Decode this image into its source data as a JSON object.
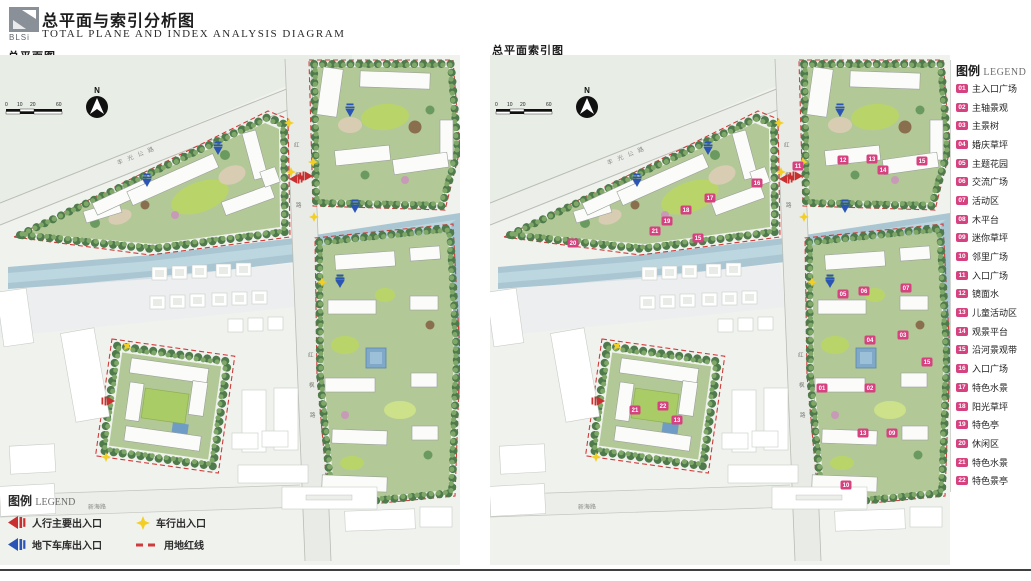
{
  "header": {
    "logo_text": "BLSi",
    "title": "总平面与索引分析图",
    "subtitle": "TOTAL PLANE AND INDEX ANALYSIS DIAGRAM"
  },
  "plans": {
    "left": {
      "title": "总平面图",
      "subtitle": "GENERAL PLAN ANALYSIS"
    },
    "right": {
      "title": "总平面索引图",
      "subtitle": "TOTAL PLANE INDEX GRAPH"
    }
  },
  "map": {
    "north_label": "N",
    "scale_ticks": [
      "0",
      "10",
      "20",
      "60"
    ],
    "road_labels": {
      "highway": "丰光公路",
      "bottom": "新海路"
    },
    "road_chars": [
      "红",
      "枫",
      "路"
    ]
  },
  "colors": {
    "badge_pink": "#d6417f",
    "pedestrian_red": "#c92f2f",
    "vehicle_yellow": "#f3cf25",
    "garage_blue": "#2b55b5",
    "redline": "#cf3b3b"
  },
  "index_legend": {
    "title": "图例",
    "title_en": "LEGEND",
    "items": [
      {
        "num": "01",
        "label": "主入口广场"
      },
      {
        "num": "02",
        "label": "主轴景观"
      },
      {
        "num": "03",
        "label": "主景树"
      },
      {
        "num": "04",
        "label": "婚庆草坪"
      },
      {
        "num": "05",
        "label": "主题花园"
      },
      {
        "num": "06",
        "label": "交流广场"
      },
      {
        "num": "07",
        "label": "活动区"
      },
      {
        "num": "08",
        "label": "木平台"
      },
      {
        "num": "09",
        "label": "迷你草坪"
      },
      {
        "num": "10",
        "label": "邻里广场"
      },
      {
        "num": "11",
        "label": "入口广场"
      },
      {
        "num": "12",
        "label": "镜面水"
      },
      {
        "num": "13",
        "label": "儿童活动区"
      },
      {
        "num": "14",
        "label": "观景平台"
      },
      {
        "num": "15",
        "label": "沿河景观带"
      },
      {
        "num": "16",
        "label": "入口广场"
      },
      {
        "num": "17",
        "label": "特色水景"
      },
      {
        "num": "18",
        "label": "阳光草坪"
      },
      {
        "num": "19",
        "label": "特色亭"
      },
      {
        "num": "20",
        "label": "休闲区"
      },
      {
        "num": "21",
        "label": "特色水景"
      },
      {
        "num": "22",
        "label": "特色景亭"
      }
    ]
  },
  "entrance_legend": {
    "title": "图例",
    "title_en": "LEGEND",
    "items": [
      {
        "icon": "pedestrian-entrance-icon",
        "label": "人行主要出入口"
      },
      {
        "icon": "vehicle-entrance-icon",
        "label": "车行出入口"
      },
      {
        "icon": "garage-entrance-icon",
        "label": "地下车库出入口"
      },
      {
        "icon": "redline-icon",
        "label": "用地红线"
      }
    ]
  },
  "markers": [
    {
      "n": "20",
      "x": 83,
      "y": 188
    },
    {
      "n": "21",
      "x": 165,
      "y": 176
    },
    {
      "n": "19",
      "x": 177,
      "y": 166
    },
    {
      "n": "18",
      "x": 196,
      "y": 155
    },
    {
      "n": "17",
      "x": 220,
      "y": 143
    },
    {
      "n": "16",
      "x": 267,
      "y": 128
    },
    {
      "n": "15",
      "x": 208,
      "y": 183
    },
    {
      "n": "11",
      "x": 308,
      "y": 111
    },
    {
      "n": "12",
      "x": 353,
      "y": 105
    },
    {
      "n": "13",
      "x": 382,
      "y": 104
    },
    {
      "n": "14",
      "x": 393,
      "y": 115
    },
    {
      "n": "15",
      "x": 432,
      "y": 106
    },
    {
      "n": "05",
      "x": 353,
      "y": 239
    },
    {
      "n": "06",
      "x": 374,
      "y": 236
    },
    {
      "n": "07",
      "x": 416,
      "y": 233
    },
    {
      "n": "04",
      "x": 380,
      "y": 285
    },
    {
      "n": "03",
      "x": 413,
      "y": 280
    },
    {
      "n": "15",
      "x": 437,
      "y": 307
    },
    {
      "n": "01",
      "x": 332,
      "y": 333
    },
    {
      "n": "02",
      "x": 380,
      "y": 333
    },
    {
      "n": "13",
      "x": 373,
      "y": 378
    },
    {
      "n": "09",
      "x": 402,
      "y": 378
    },
    {
      "n": "10",
      "x": 356,
      "y": 430
    },
    {
      "n": "21",
      "x": 145,
      "y": 355
    },
    {
      "n": "22",
      "x": 173,
      "y": 351
    },
    {
      "n": "13",
      "x": 187,
      "y": 365
    }
  ],
  "arrows": [
    {
      "t": "ped",
      "x": 289,
      "y": 124,
      "a": 180
    },
    {
      "t": "ped",
      "x": 313,
      "y": 121,
      "a": 0
    },
    {
      "t": "ped",
      "x": 115,
      "y": 346,
      "a": 0
    },
    {
      "t": "veh",
      "x": 289,
      "y": 68,
      "a": 180
    },
    {
      "t": "veh",
      "x": 291,
      "y": 117,
      "a": 180
    },
    {
      "t": "veh",
      "x": 313,
      "y": 107,
      "a": 0
    },
    {
      "t": "veh",
      "x": 314,
      "y": 162,
      "a": 0
    },
    {
      "t": "veh",
      "x": 322,
      "y": 227,
      "a": 0
    },
    {
      "t": "veh",
      "x": 127,
      "y": 291,
      "a": 35
    },
    {
      "t": "veh",
      "x": 106,
      "y": 402,
      "a": 0
    },
    {
      "t": "gar",
      "x": 218,
      "y": 100,
      "a": 90
    },
    {
      "t": "gar",
      "x": 147,
      "y": 132,
      "a": 90
    },
    {
      "t": "gar",
      "x": 350,
      "y": 62,
      "a": 90
    },
    {
      "t": "gar",
      "x": 355,
      "y": 158,
      "a": 90
    },
    {
      "t": "gar",
      "x": 340,
      "y": 233,
      "a": 90
    }
  ]
}
